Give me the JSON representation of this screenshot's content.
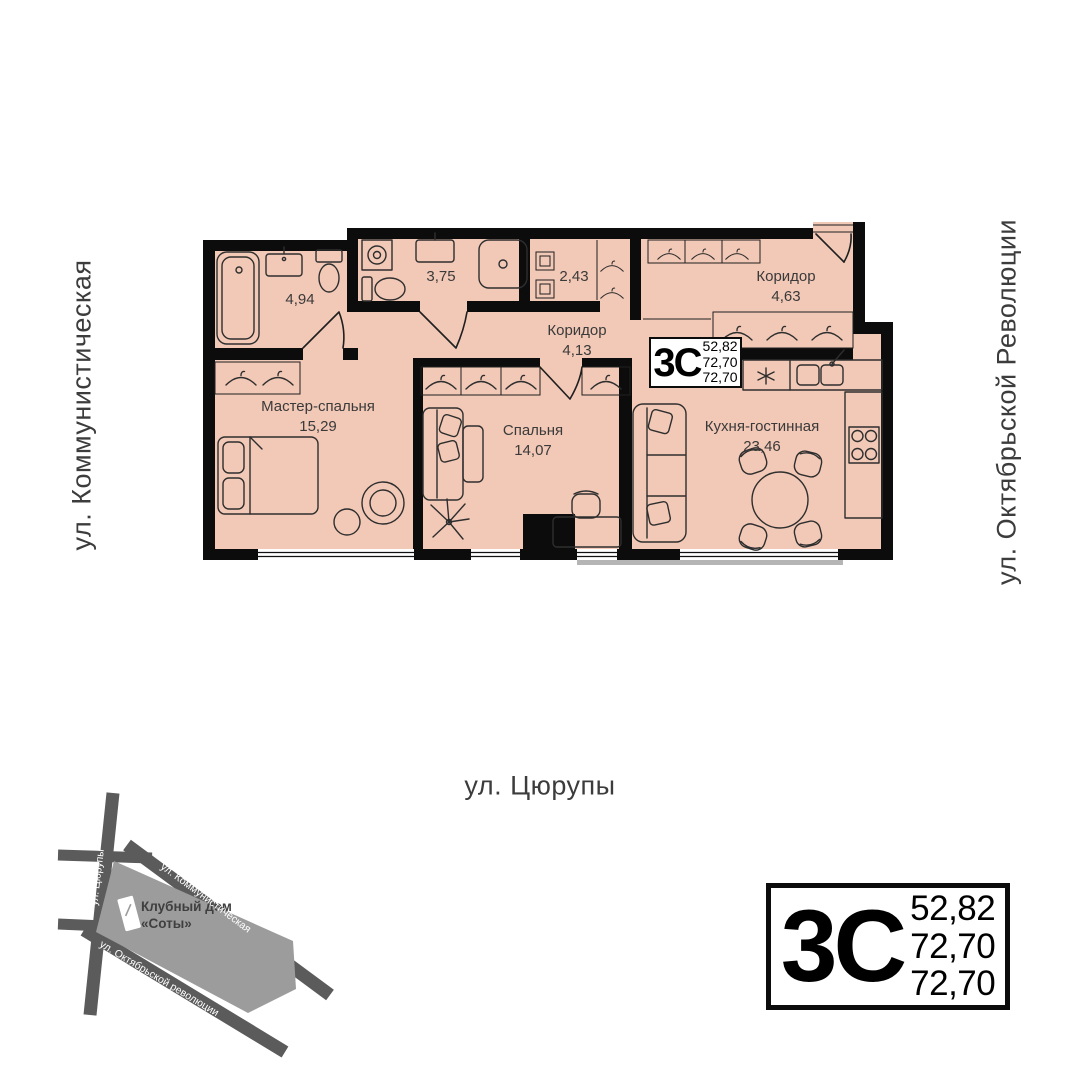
{
  "street_labels": {
    "left": "ул. Коммунистическая",
    "right": "ул. Октябрьской Революции",
    "bottom": "ул. Цюрупы"
  },
  "rooms": {
    "master_bedroom": {
      "label": "Мастер-спальня",
      "area": "15,29"
    },
    "bedroom": {
      "label": "Спальня",
      "area": "14,07"
    },
    "kitchen_living": {
      "label": "Кухня-гостинная",
      "area": "23,46"
    },
    "corridor_main": {
      "label": "Коридор",
      "area": "4,13"
    },
    "corridor_entry": {
      "label": "Коридор",
      "area": "4,63"
    },
    "bathroom_large": {
      "area": "4,94"
    },
    "bathroom_small": {
      "area": "3,75"
    },
    "storage": {
      "area": "2,43"
    }
  },
  "apartment_badge": {
    "type_label": "3С",
    "areas": [
      "52,82",
      "72,70",
      "72,70"
    ]
  },
  "map": {
    "building_line1": "Клубный дом",
    "building_line2": "«Соты»",
    "street_vertical": "ул. Цюрупы",
    "street_top": "ул. Коммунистическая",
    "street_bottom": "ул. Октябрьской революции"
  },
  "colors": {
    "room_fill": "#f2c8b6",
    "wall": "#0c0c0c",
    "map_block": "#9c9c9c",
    "map_street": "#5b5b5b"
  }
}
